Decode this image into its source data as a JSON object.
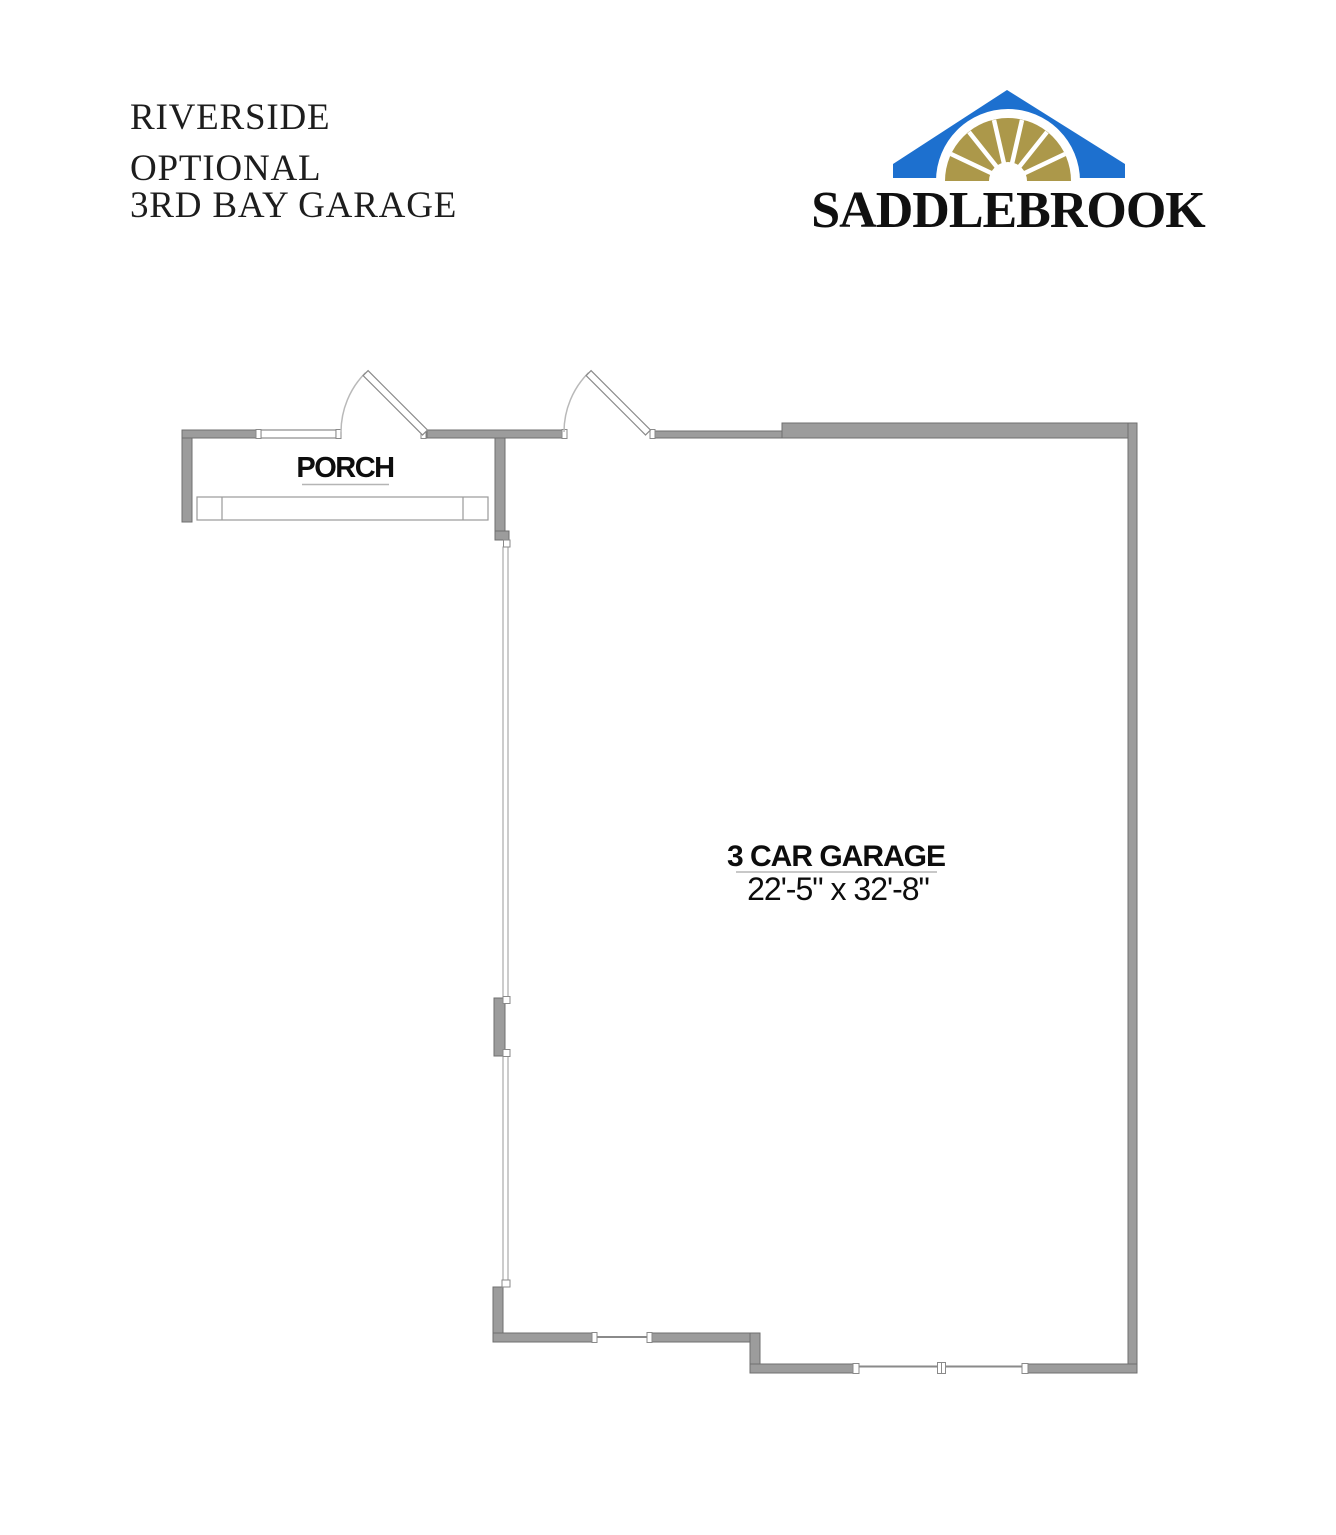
{
  "title_block": {
    "line1": "RIVERSIDE",
    "line2": "OPTIONAL",
    "line3": "3RD BAY GARAGE"
  },
  "logo": {
    "brand": "SADDLEBROOK",
    "roof_color": "#1d70cf",
    "fan_color": "#ac984a",
    "text_color": "#101010"
  },
  "floorplan": {
    "wall_color": "#9c9c9c",
    "porch_label": "PORCH",
    "garage_label": "3 CAR GARAGE",
    "garage_dimensions": "22'-5\" x 32'-8\""
  }
}
